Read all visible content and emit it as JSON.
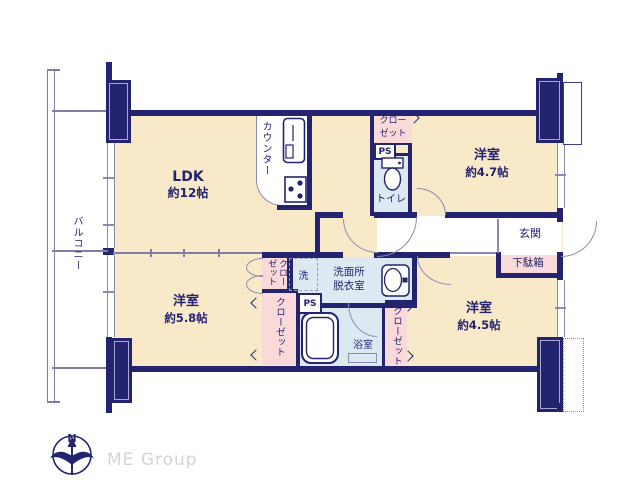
{
  "floorplan": {
    "rooms": [
      {
        "id": "ldk",
        "label": "LDK",
        "size": "約12帖"
      },
      {
        "id": "bedroom-ne",
        "label": "洋室",
        "size": "約4.7帖"
      },
      {
        "id": "bedroom-sw",
        "label": "洋室",
        "size": "約5.8帖"
      },
      {
        "id": "bedroom-se",
        "label": "洋室",
        "size": "約4.5帖"
      }
    ],
    "areas": {
      "balcony": "バルコニー",
      "counter": "カウンター",
      "closet": "クローゼット",
      "closet_line1": "クロー",
      "closet_line2": "ゼット",
      "ps": "PS",
      "toilet": "トイレ",
      "washroom_line1": "洗面所",
      "washroom_line2": "脱衣室",
      "washer": "洗",
      "bathroom": "浴室",
      "entrance": "玄関",
      "shoe_cabinet": "下駄箱"
    },
    "compass": {
      "north_label": "N"
    },
    "brand": {
      "name": "ME Group"
    },
    "colors": {
      "wall": "#23236f",
      "room_fill": "#f8e9c9",
      "closet_fill": "#f9d9da",
      "wet_area_fill": "#dde9f2",
      "thin_line": "#8a8ab2",
      "label_text": "#23236f",
      "brand_text": "#d4d4d4"
    }
  }
}
